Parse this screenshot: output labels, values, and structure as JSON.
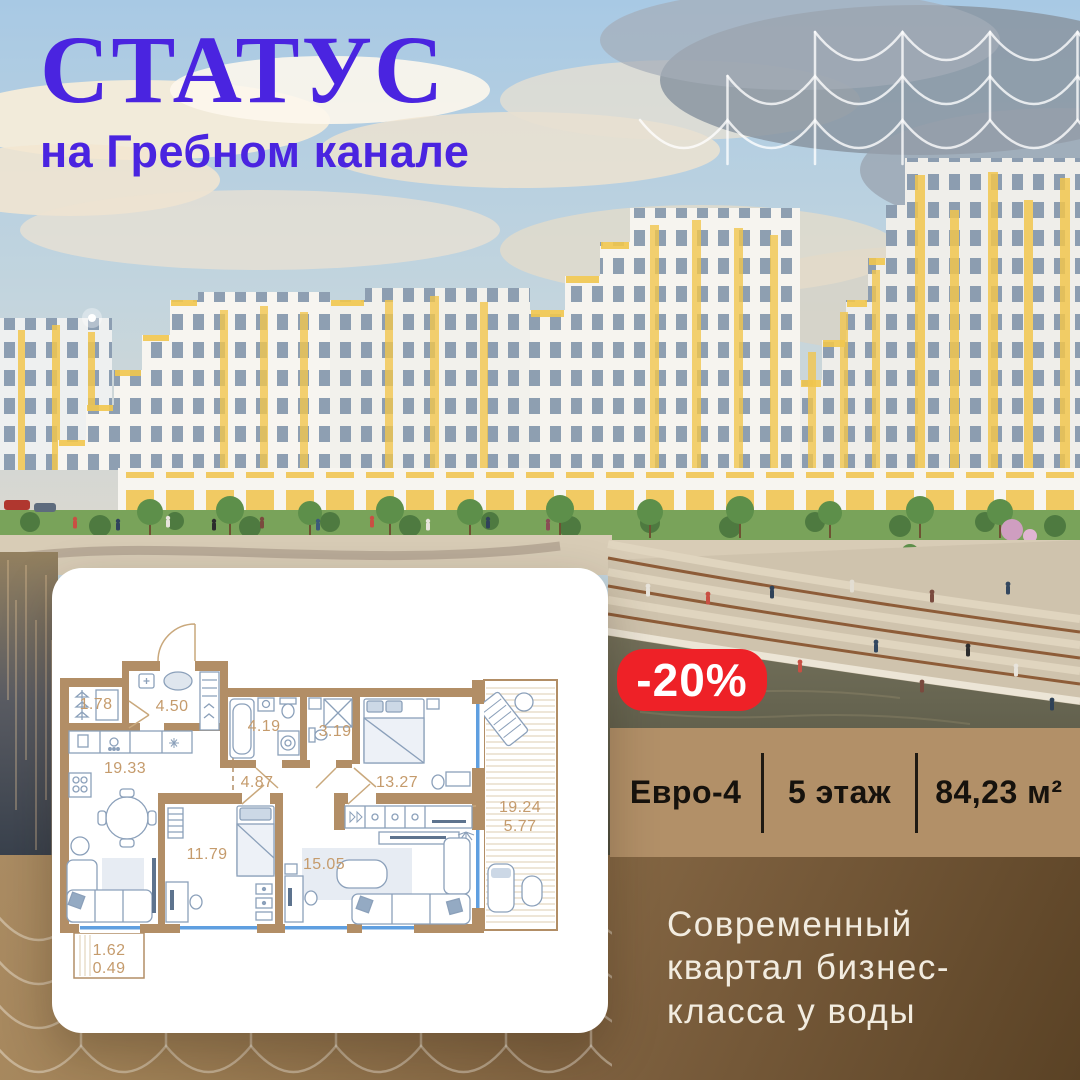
{
  "logo": {
    "title": "СТАТУС",
    "subtitle": "на Гребном канале"
  },
  "badge": {
    "discount": "-20%"
  },
  "offer": {
    "layout": "Евро-4",
    "floor": "5 этаж",
    "area": "84,23 м²"
  },
  "tagline": {
    "lines": [
      "Современный",
      "квартал бизнес-",
      "класса у воды"
    ]
  },
  "floorplan": {
    "rooms": [
      {
        "id": "wardrobe",
        "area": "1.78"
      },
      {
        "id": "hallway",
        "area": "4.50"
      },
      {
        "id": "kitchen-living",
        "area": "19.33"
      },
      {
        "id": "bathroom",
        "area": "4.19"
      },
      {
        "id": "wc",
        "area": "3.19"
      },
      {
        "id": "corridor",
        "area": "4.87"
      },
      {
        "id": "bedroom-1",
        "area": "13.27"
      },
      {
        "id": "bedroom-2",
        "area": "11.79"
      },
      {
        "id": "living-room",
        "area": "15.05"
      }
    ],
    "terrace": {
      "area_total": "19.24",
      "area_reduced": "5.77"
    },
    "balcony": {
      "area_total": "1.62",
      "area_reduced": "0.49"
    }
  },
  "colors": {
    "accent_purple": "#4a24e0",
    "badge_red": "#ee2127",
    "panel_tan": "#b29068",
    "panel_brown_dark": "#5a4225",
    "wall_tan": "#b28e66",
    "plan_label_tan": "#c59b6c",
    "window_blue": "#5f9fe0",
    "facade_yellow": "#f1c64e"
  }
}
